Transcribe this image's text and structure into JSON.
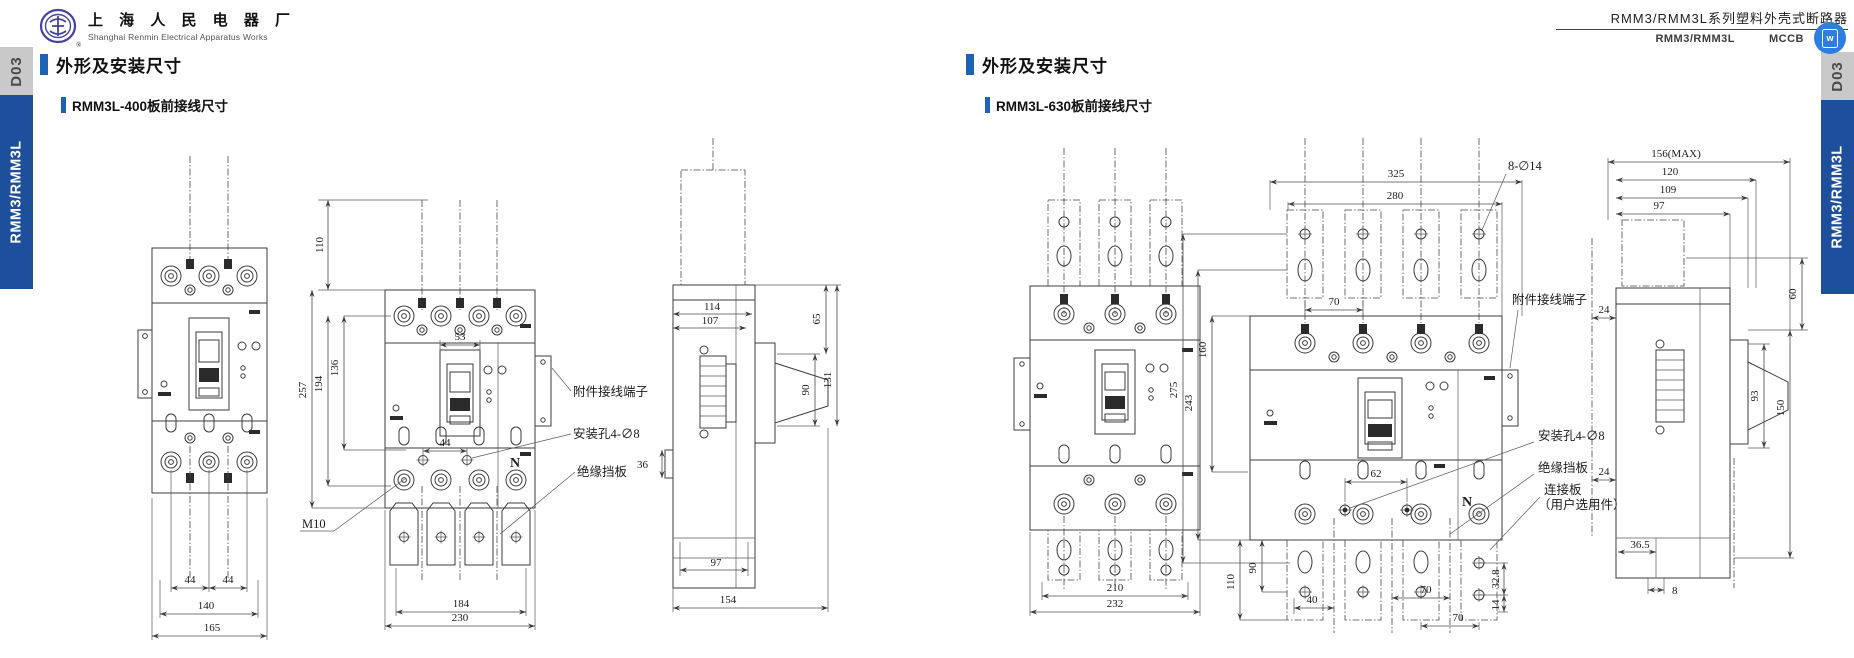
{
  "header": {
    "company_cn": "上 海 人 民 电 器 厂",
    "company_en": "Shanghai Renmin Electrical Apparatus Works",
    "product_title": "RMM3/RMM3L系列塑料外壳式断路器",
    "product_series": "RMM3/RMM3L",
    "product_type": "MCCB",
    "badge_letter": "w"
  },
  "sidebar": {
    "page_tab": "D03",
    "series_tab": "RMM3/RMM3L"
  },
  "left_section": {
    "section_title": "外形及安装尺寸",
    "drawing_title": "RMM3L-400板前接线尺寸",
    "front_view": {
      "dim_pole_pitch_1": "44",
      "dim_pole_pitch_2": "44",
      "dim_width_inner": "140",
      "dim_width_overall": "165"
    },
    "four_pole_view": {
      "dim_wire_length": "110",
      "dim_height_overall": "257",
      "dim_height_mid": "194",
      "dim_height_inner": "136",
      "dim_handle_width": "53",
      "dim_hole_spacing": "44",
      "dim_plate_span": "184",
      "dim_width_overall": "230",
      "label_terminal_thread": "M10",
      "label_neutral": "N",
      "label_accessory_terminal": "附件接线端子",
      "label_mounting_hole": "安装孔4-∅8",
      "label_insulation_plate": "绝缘挡板"
    },
    "side_view": {
      "dim_depth_1": "114",
      "dim_depth_2": "107",
      "dim_h_top": "65",
      "dim_handle": "90",
      "dim_h_total": "131",
      "dim_step": "36",
      "dim_depth_lower": "97",
      "dim_depth_overall": "154"
    }
  },
  "right_section": {
    "section_title": "外形及安装尺寸",
    "drawing_title": "RMM3L-630板前接线尺寸",
    "front_view": {
      "dim_width_inner": "210",
      "dim_width_overall": "232"
    },
    "four_pole_view": {
      "dim_plate_span": "325",
      "dim_width_inner": "280",
      "label_hole": "8-∅14",
      "dim_pole_pitch": "70",
      "dim_height_overall": "275",
      "dim_height_mid": "243",
      "dim_height_upper": "160",
      "dim_hole_spacing": "62",
      "dim_plate_len": "110",
      "dim_plate_hole": "90",
      "dim_wire_offset": "40",
      "dim_pitch_a": "70",
      "dim_pitch_b": "70",
      "dim_plate_hole_spacing": "32.8",
      "dim_plate_hole_edge": "14",
      "label_accessory_terminal": "附件接线端子",
      "label_mounting_hole": "安装孔4-∅8",
      "label_insulation_plate": "绝缘挡板",
      "label_connector_line1": "连接板",
      "label_connector_line2": "（用户选用件）",
      "label_neutral": "N"
    },
    "side_view": {
      "dim_max": "156(MAX)",
      "dim_d1": "120",
      "dim_d2": "109",
      "dim_d3": "97",
      "dim_off_top": "24",
      "dim_off_mid": "24",
      "dim_h_top": "60",
      "dim_h_mid": "93",
      "dim_h_total": "150",
      "dim_step": "36.5",
      "dim_edge": "8"
    }
  }
}
